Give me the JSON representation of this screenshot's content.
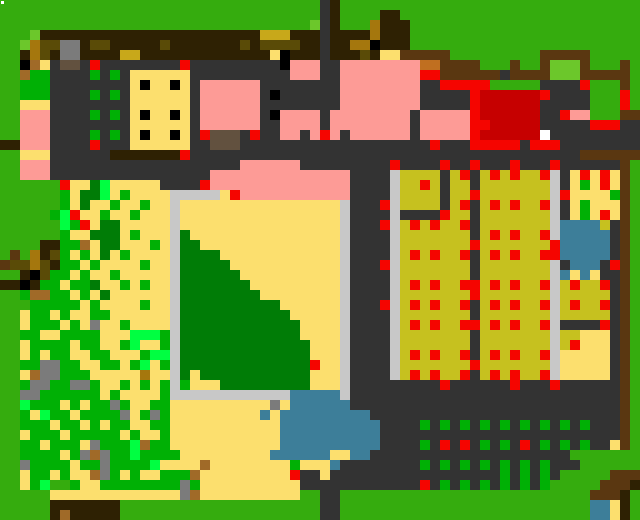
{
  "map": {
    "label": "Pixel farm overworld map",
    "cols": 64,
    "rows": 52,
    "cell_px": 10,
    "palette": {
      "G": {
        "color": "#35ac0e",
        "name": "grass"
      },
      "L": {
        "color": "#6cc72b",
        "name": "light-green-shrub"
      },
      "g": {
        "color": "#00b005",
        "name": "bush-green"
      },
      "N": {
        "color": "#00ff41",
        "name": "neon-green-sprout"
      },
      "E": {
        "color": "#007c06",
        "name": "dark-green-grove"
      },
      "D": {
        "color": "#333333",
        "name": "charcoal-yard"
      },
      "A": {
        "color": "#7b7b7b",
        "name": "stone-gray"
      },
      "S": {
        "color": "#c8c8c8",
        "name": "silver-border-path"
      },
      "B": {
        "color": "#2e2103",
        "name": "dark-brown-canopy"
      },
      "b": {
        "color": "#5a3711",
        "name": "saddle-brown-fence"
      },
      "T": {
        "color": "#62513f",
        "name": "taupe-doorway"
      },
      "t": {
        "color": "#a06a28",
        "name": "tan-stump"
      },
      "n": {
        "color": "#c06f20",
        "name": "orange-crate"
      },
      "o": {
        "color": "#a5770d",
        "name": "golden-log"
      },
      "O": {
        "color": "#5a4b07",
        "name": "olive-log"
      },
      "M": {
        "color": "#c8a81a",
        "name": "mustard-roof-trim"
      },
      "Y": {
        "color": "#fcdf6e",
        "name": "pale-yellow-sand"
      },
      "K": {
        "color": "#c6c11f",
        "name": "khaki-crop-field"
      },
      "P": {
        "color": "#fd9b96",
        "name": "pink-building"
      },
      "R": {
        "color": "#f50500",
        "name": "red-marker"
      },
      "Q": {
        "color": "#c60000",
        "name": "dark-red-barn-roof"
      },
      "C": {
        "color": "#3d7e99",
        "name": "pond-blue"
      },
      "X": {
        "color": "#000000",
        "name": "black-window"
      },
      "W": {
        "color": "#ffffff",
        "name": "white-tile"
      }
    },
    "grid": [
      "GGGGGGGGGGGGGGGGGGGGGGGGGGGGGGGGDBGGGGGGGGGGGGGGGGGGGGGGGGGGGG",
      "GGGGGGGGGGGGGGGGGGGGGGGGGGGGGGGGDBGGGGBBGGGGGGGGGGGGGGGGGGGGGG",
      "GGGGGGGGGGGGGGGGGGGGGGGGGGGGGGGLDBGGGoBBBGGGGGGGGGGGGGGGGGGGGG",
      "GGGLBBBBBBBBBBBBBBBBBBBBBBMMMBBBDBBBBoBBBGGGGGGGGGGGGGGGGGGGGGG",
      "GGLoOOAABOOBBBBBOBBBBBBBOBOOOOBBDBBooXBBBGGGGGGGGGGGGGGGGGGGGGG",
      "GGBoOBAABBBBMMBBBBBBBBBBBBBYXBBBDBBBOBYYbbbbbGGGGGGGGGbbbbbGGGGG",
      "GGXtYDTTDRDDDDDDDDRDDDDDDDDDXPPPDDPPPPPPPPnnbbbbGGGbGGbLLLbGGGbG",
      "GGtggDDDDgDgDYYYYYYDDDDDDDDDDPPPDDPPPPPPPPRRbbbbbbDbbbbLLLbbbbbG",
      "GGgggDDDDDDDDYXYYXYDPPPPPPDDDDDDDDPPPPPPPPDDRRRRRGGGGGDDDDRGGGbG",
      "GGgggDDDDgDgDYYYYYYDPPPPPPDXDDDDDDPPPPPPPPDDDDDRQQQQQQRDDDDGGGRG",
      "GGYYYDDDDDDDDYYYYYYDPPPPPPDDDDDDDDPPPPPPPPDDDDDRQQQQQQDDDDDGGGRG",
      "GGPPPDDDDgDgDYXYYXYDPPPPPPDXPPPPDPPPPPPPPDPPPPPRQQQQQQDDRPPGGGbb",
      "GGPPPDDDDDDDDYYYYYYDPPPPPPDDPPPPDPPPPPPPPDPPPPPRRQQQQQDDDDDRRRDD",
      "GGPPPDDDDgDgDYXYYXYDRTTTDRDDPPDPRPDPPPPPPDPPPPPRQQQQQQWDDDDDDDDD",
      "BBPPPDDDDRDDDYYYYYYDDTTTDDDDDDDDDDDDDDDDDDDRDDDRRRRRDRRRDDDDDDDD",
      "GGYYYDDDDDDBBBBBBBRDDDDDDDDDDDDDDDDDDDDDDDDDDDDDDDDDDDDDDDbbbbbb",
      "GGPPPDDDDDDDDDDDDDDDDDDDPPPPPPDDDDDDDDDRDDDDRDDRDDDRDDDRDDDDDDbG",
      "GGPPPDDDDDDDDDDDDDDDDPPPPPPPPPPPPPPDDDDSKKKKDKRDKRKRKKRSDYRYRYbG",
      "GGGGGGRYYENYYYYYDDDDRPPPPPPPPPPPPPPDDDDSKKRKDKKDKKKKKKKSDYgYRYbG",
      "GGGGGGgYEENYgYYYYSSSSSYRPPPPPPPPPPPDDDDSKKKKDKKRKKKKKKKSRYYYYgbG",
      "GGGGGGgYEYYgYYgYYSYYYYYYYYYYYYYYYYSDDDRSKKKKDKRDKRKRKKRSDYgYYYbG",
      "GGGGGgNRYYgYYgYYYSYYYYYYYYYYYYYYYYSDDDDSDDDDRKKDKKKKKKKSDYgYRYbG",
      "GGGGGGNgRYEEYYYYYSYYYYYYYYYYYYYYYYSDDDRSKRKRKKRDKKKKKKKSCCCCKDbG",
      "GGGGGGgYYEEEYgYYYSEYYYYYYYYYYYYYYYSDDDDSKKKKKKKDKRKRKKRSCCCCCDbG",
      "GGGGBBggtYEEYYYgYSEEYYYYYYYYYYYYYYSDDDDSKKKKKKKRKKKKKKKRCCCCCDbG",
      "GbGoBOgYgYEYgYYYYSEEEEYYYYYYYYYYYYSDDDDSKRKRKKRDKRKRKKRRCCCCCDbG",
      "bOOoOBggYgYYYYgYYSEEEEEYYYYYYYYYYYSDDDRSKKKKKKKDKKKKKKKSDCCCDRbG",
      "GGBXOggYgYYgYYYYYSEEEEEEYYYYYYYYYYSDDDDSKKKKKKKDKKKKKKKSCYCYDDbG",
      "BBXBggYggEYYgYgYYSEEEEEEEYYYYYYYYYSDDDDSKRKRKKRRKRKRKKRSKRKKRDbG",
      "GGgttggYgYEYYYYYYSEEEEEEEEYYYYYYYYSDDDDSKKKKKKKRKKKKKKKSKKKKKDbG",
      "GGGgggggYgYYYYgYYSEEEEEEEEEEYYYYYYSDDDRSKRKRKKRDKRKRKKRSKRKKRDbG",
      "GGYggYgYYggYYYYYYSEEEEEEEEEEEYYYYYSDDDDSKKKKKKKDKKKKKKKSKKKKKDbG",
      "GGYgggYgYAYYgYYYYSEEEEEEEEEEEEYYYYSDDDDSKRKRKKRRKRKRKKRSDDDDRDbG",
      "GGggYYggggYYYNNNgSEEEEEEEEEEEEYYYYSDDDDSKKKKKKKDKKKKKKKSKKYYYDbG",
      "GGYggggYggYYgNYYgSEEEEEEEEEEEEEYYYSDDDDSKKKKKKKDKKKKKKKSKRYYYDbG",
      "GGYgYggYYggYYYgNNSEEEEEEEEEEEEEYYYSDDDDSKRKRKKRDKRKRKKRSYYYYYDbG",
      "GGggAAggYYggYgNYgSEEEEEEEEEEEEERYYSDDDDSKKKKKKKRKKKKKKKSYYYYYDbG",
      "GGYtAAgggYYYYYoYYSEYEEEEEEEEEEEYYYSDDDDSKRKRKKRDKRKRKKRSYYYYYDbG",
      "GGgAAggAAgYYgYgYgSgYYYEEEEEEEEEYYYSDDDDDDDDDRDDDDDDRDDDRDDDDDDbG",
      "GGAAggggggYgYYYYgSSSSSSSSSSSSCCCCCSDDDDDDDDDDDDDDDDDDDDDDDDDDDbG",
      "GGNgggYgYggAgYYggYYYYYYYYYYAYCCCCCCDDDDDDDDDDDDDDDDDDDDDDDDDDDbG",
      "GGgYNggYggggAYgAgYYYYYYYYYCYCCCCCCCCCDDDDDDDDDDDDDDDDDDDDDDDDDbG",
      "GGgggYggYgYggYYggYYYYYYYYYYYCCCCCCCCCCDDDDgDgDgDgDgDgDgDgDgDDDbG",
      "GGYgggYgggggYgYYgYYYYYYYYYYYCCCCCCCCCCDDDDDDDDDDDDDDDDDDDDDDDDbG",
      "GGggYgggYAgggNtggYYYYYYYYYYYCCCCCCCCCCDDDDgDRDRDgDgDRDgDgDgDDYbG",
      "GGggggYgAtAggNggggYYYYYYYYYCCCCCCYYCCDDDDDDDDDDDDDDDDDDDDGGGGGG",
      "GGAggggYggAggggNYYYYtYYYYYYYYgYYYCDDDDDDDDgDgDgDgDgDgDgDDDGGGGGG",
      "GGYggYgYYtAgYgYYgggtYYYYYYYYYRDDYDDDDDDDDDDDDDDDDDgDgDgDGGGGGbbbL",
      "GGYgNGGgYYggggggggAgYYYYYYYYYYDDDDDDDDDDDDRDgDgDgDgDgDgGGGGGbbbB",
      "GGGGGYYYYYYYYYYYYYAtYYYYYYYYYYGGDDGGGGGGGGGGGGGGGGGGGGGGGGGbbbB",
      "GGGGGBBBBBBBGGGGGGGGGGGGGGGGGGGGDDGGGGGGGGGGGGGGGGGGGGGGGGGCCYB",
      "GGGGGBtBBBBBGGGGGGGGGGGGGGGGGGGGDDGGGGGGGGGGGGGGGGGGGGGGGGGCCYB",
      "GGGGGBtBBBBBGGGGGGGGGGGGGGGGGGGGDDGGGGGGGGGGGGGGGGGGGGGGGGGCCYB"
    ],
    "artifact": {
      "x": 1,
      "y": 1,
      "w": 3,
      "h": 3,
      "color": "#ffffff"
    },
    "regions": [
      {
        "name": "tree-canopy-band",
        "desc": "dark brown canopy strip across the top"
      },
      {
        "name": "charcoal-farmyard",
        "desc": "large dark gray yard with buildings"
      },
      {
        "name": "pink-buildings",
        "desc": "salmon roofed houses with taupe doors and red corner markers"
      },
      {
        "name": "dark-red-barn",
        "desc": "dark red roof block right of center with white tile"
      },
      {
        "name": "yellow-shed",
        "desc": "pale yellow building with six black windows"
      },
      {
        "name": "crop-fields",
        "desc": "two khaki field columns dotted with red produce"
      },
      {
        "name": "garden-plot",
        "desc": "small yellow plot with red and green sprouts, top right"
      },
      {
        "name": "ponds",
        "desc": "steel blue ponds center-bottom, right, and bottom-right corner"
      },
      {
        "name": "sand-court",
        "desc": "pale sand area framed by silver border with dark green grove"
      },
      {
        "name": "forest-mosaic",
        "desc": "noisy green/yellow scrub with gray rocks and logs on the left"
      },
      {
        "name": "orchard-dots",
        "desc": "grid of green and red dots on charcoal, bottom right"
      }
    ]
  }
}
